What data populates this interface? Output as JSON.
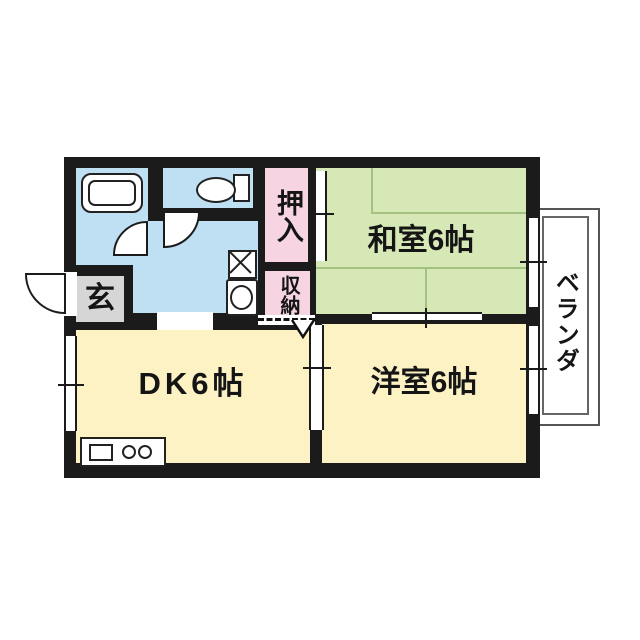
{
  "floor_plan": {
    "rooms": {
      "japanese_room": {
        "label": "和室6帖",
        "size_mats": 6
      },
      "western_room": {
        "label": "洋室6帖",
        "size_mats": 6
      },
      "dining_kitchen": {
        "label": "DK6帖",
        "size_mats": 6
      },
      "entrance": {
        "label": "玄"
      },
      "closet": {
        "label": "押入"
      },
      "storage": {
        "label": "収納"
      },
      "veranda": {
        "label": "ベランダ"
      }
    },
    "fixtures": {
      "bathtub": "bathtub-icon",
      "toilet": "toilet-icon",
      "washing_machine": "washing-machine-icon",
      "washbasin": "washbasin-icon",
      "kitchen_counter": "kitchen-sink-and-burners-icon"
    },
    "colors": {
      "japanese_room": "#d6e8b6",
      "western_room": "#fcf2c4",
      "dining_kitchen": "#fcf2c4",
      "wet_area": "#bfdff3",
      "closet": "#f7d4e2",
      "storage": "#f7d4e2",
      "entrance": "#d6d6d6",
      "wall": "#1b1b1b"
    }
  }
}
